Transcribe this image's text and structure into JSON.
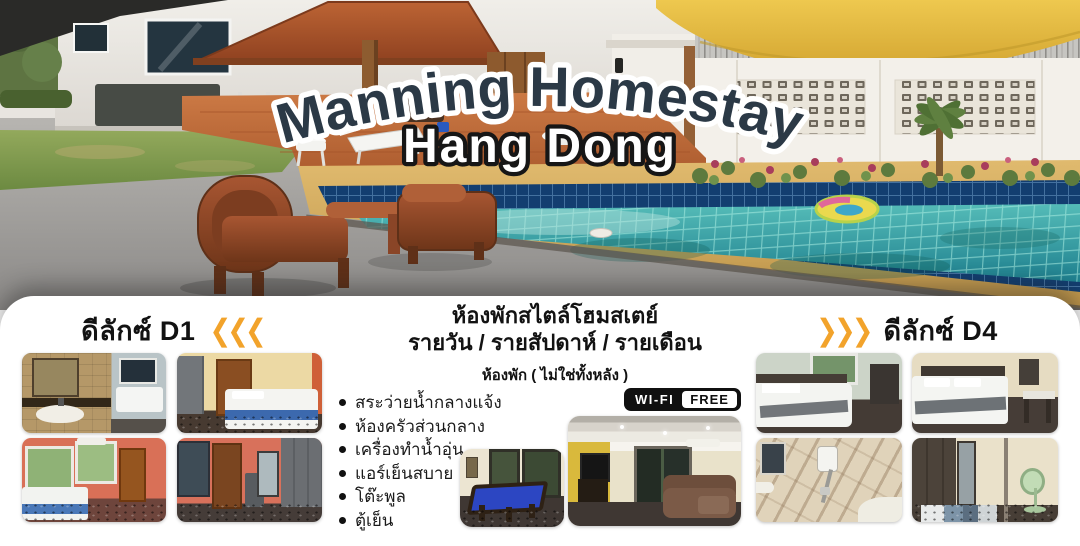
{
  "hero": {
    "title": "Manning Homestay",
    "subtitle": "Hang Dong"
  },
  "panel": {
    "left": {
      "title": "ดีลักซ์ D1",
      "chevrons": "❮❮❮"
    },
    "right": {
      "title": "ดีลักซ์ D4",
      "chevrons": "❯❯❯"
    },
    "center": {
      "heading_line1": "ห้องพักสไตล์โฮมสเตย์",
      "heading_line2": "รายวัน / รายสัปดาห์ / รายเดือน",
      "subheading": "ห้องพัก ( ไม่ใช่ทั้งหลัง )",
      "amenities": [
        "สระว่ายน้ำกลางแจ้ง",
        "ห้องครัวส่วนกลาง",
        "เครื่องทำน้ำอุ่น",
        "แอร์เย็นสบาย",
        "โต๊ะพูล",
        "ตู้เย็น"
      ],
      "wifi": {
        "left": "WI-FI",
        "right": "FREE"
      }
    }
  },
  "colors": {
    "accent_orange": "#F2A32B",
    "title_navy": "#2B3946",
    "subtitle_white": "#FFFFFF",
    "panel_bg": "#FFFFFF",
    "pool_water": "#3FA8A2",
    "pool_tile": "#13406E",
    "text_black": "#111111"
  }
}
